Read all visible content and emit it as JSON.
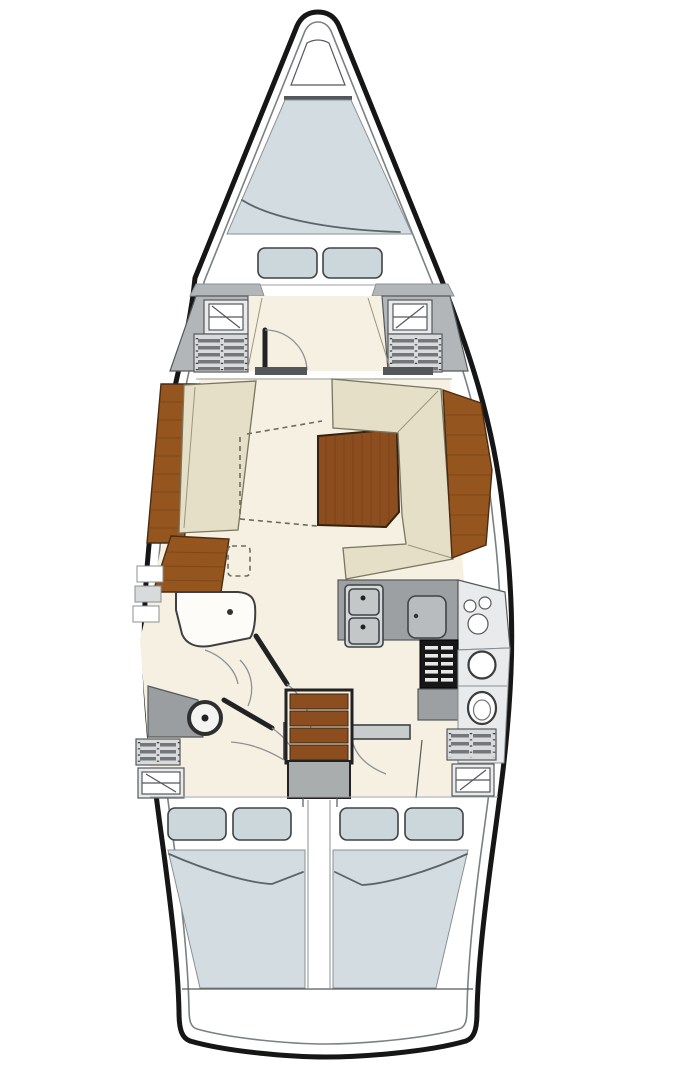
{
  "diagram": {
    "kind": "sailing-yacht-interior-floor-plan",
    "orientation": "bow-up",
    "rooms": [
      "anchor-locker",
      "forward-cabin-v-berth",
      "saloon-with-folding-table",
      "galley",
      "wet-head",
      "nav-seat-area",
      "companionway",
      "aft-cabin-port",
      "aft-cabin-starboard"
    ]
  },
  "colors": {
    "background": "#ffffff",
    "hull_outline": "#1a1a1a",
    "inner_line": "#7b8082",
    "berth_blue": "#d3dce0",
    "pillow_blue": "#ccd7db",
    "pillow_border": "#4d565a",
    "floor_cream": "#f5f0e2",
    "cushion_beige": "#e6dfc7",
    "wood": "#95551f",
    "wood_dark": "#8c4e1e",
    "counter_gray": "#9da0a2",
    "unit_gray": "#b3b6b8",
    "panel_light": "#e9eaeb",
    "louver_light": "#d8dadb",
    "sink_light": "#d6d9da",
    "basin_gray": "#c3c7c8",
    "fridge_gray": "#b9bcbe",
    "dark_gray": "#54575a",
    "oven_black": "#171717",
    "white": "#ffffff",
    "stool_white": "#f4f4f2",
    "landing_gray": "#aaadae",
    "wedge_gray": "#9b9ea0",
    "slab_gray": "#c9cccd",
    "desk_white": "#fdfcf8"
  }
}
